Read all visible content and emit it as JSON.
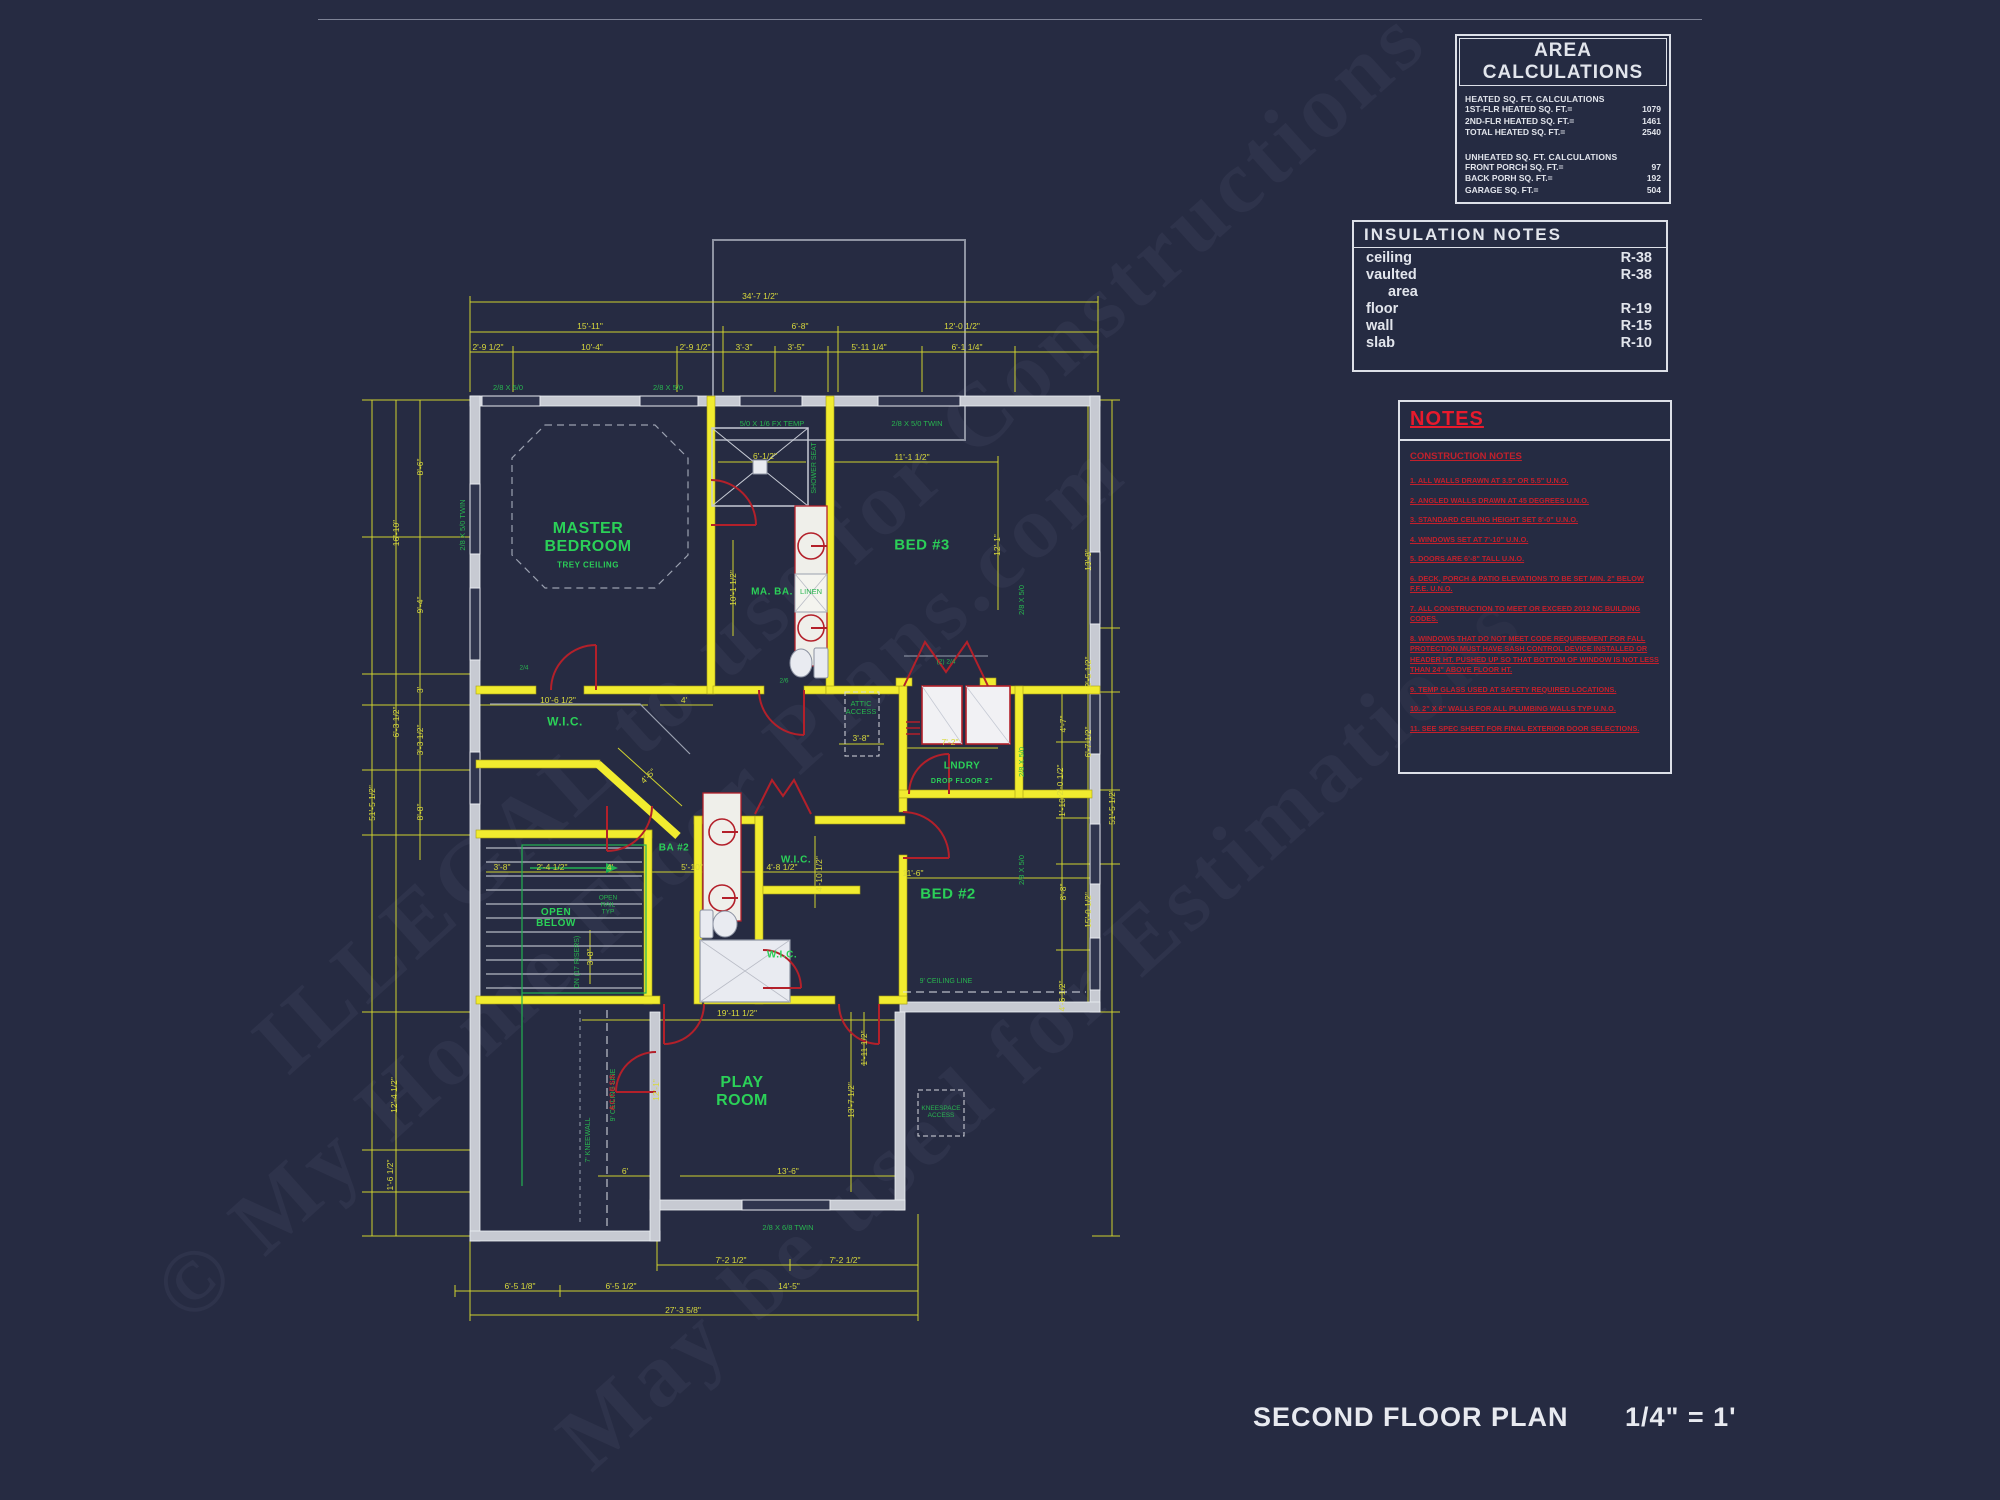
{
  "area_calculations": {
    "title": "AREA CALCULATIONS",
    "heated_header": "HEATED SQ. FT. CALCULATIONS",
    "heated_rows": [
      {
        "label": "1ST-FLR HEATED SQ. FT.=",
        "value": "1079"
      },
      {
        "label": "2ND-FLR HEATED SQ. FT.=",
        "value": "1461"
      },
      {
        "label": "TOTAL HEATED SQ. FT.=",
        "value": "2540"
      }
    ],
    "unheated_header": "UNHEATED SQ. FT. CALCULATIONS",
    "unheated_rows": [
      {
        "label": "FRONT PORCH SQ. FT.=",
        "value": "97"
      },
      {
        "label": "BACK PORH SQ. FT.=",
        "value": "192"
      },
      {
        "label": "GARAGE SQ. FT.=",
        "value": "504"
      }
    ]
  },
  "insulation_notes": {
    "title": "INSULATION  NOTES",
    "rows": [
      {
        "label": "ceiling",
        "value": "R-38"
      },
      {
        "label": "vaulted",
        "value": "R-38"
      },
      {
        "label": "area",
        "value": "",
        "indent": true
      },
      {
        "label": "floor",
        "value": "R-19"
      },
      {
        "label": "wall",
        "value": "R-15"
      },
      {
        "label": "slab",
        "value": "R-10"
      }
    ]
  },
  "notes_panel": {
    "title": "NOTES",
    "subtitle": "CONSTRUCTION NOTES",
    "items": [
      "1.  ALL WALLS DRAWN AT 3.5\" OR 5.5\" U.N.O.",
      "2.  ANGLED WALLS DRAWN AT 45 DEGREES U.N.O.",
      "3.  STANDARD CEILING HEIGHT SET 8'-0\" U.N.O.",
      "4.  WINDOWS SET AT 7'-10\" U.N.O.",
      "5.  DOORS ARE 6'-8\" TALL U.N.O.",
      "6.  DECK, PORCH & PATIO ELEVATIONS TO BE SET MIN. 2\" BELOW F.F.E. U.N.O.",
      "7.  ALL CONSTRUCTION TO MEET OR EXCEED 2012 NC BUILDING CODES.",
      "8.  WINDOWS THAT DO NOT MEET CODE REQUIREMENT FOR FALL PROTECTION MUST HAVE SASH CONTROL DEVICE INSTALLED OR HEADER HT. PUSHED UP SO THAT BOTTOM OF WINDOW IS NOT LESS THAN 24\" ABOVE FLOOR HT.",
      "9.  TEMP GLASS USED AT SAFETY REQUIRED LOCATIONS.",
      "10. 2\" X 6\" WALLS FOR ALL PLUMBING WALLS TYP U.N.O.",
      "11. SEE SPEC SHEET FOR FINAL EXTERIOR DOOR SELECTIONS."
    ]
  },
  "title_block": {
    "title": "SECOND FLOOR PLAN",
    "scale": "1/4\" = 1'"
  },
  "watermarks": [
    {
      "t": "ILLEGAL to use for Constructions",
      "x": 840,
      "y": 540,
      "r": -42,
      "fs": 90
    },
    {
      "t": "© My Home Floor Plans.com",
      "x": 640,
      "y": 880,
      "r": -42,
      "fs": 90
    },
    {
      "t": "May be used for Estimations",
      "x": 1040,
      "y": 1030,
      "r": -42,
      "fs": 90
    }
  ],
  "plan": {
    "rooms": [
      {
        "t": "MASTER\nBEDROOM",
        "x": 588,
        "y": 538,
        "fs": 16,
        "n": "room-label-master-bedroom"
      },
      {
        "t": "TREY CEILING",
        "x": 588,
        "y": 566,
        "fs": 8,
        "n": "label-trey-ceiling"
      },
      {
        "t": "W.I.C.",
        "x": 565,
        "y": 722,
        "fs": 12,
        "n": "room-label-wic-master"
      },
      {
        "t": "BED #3",
        "x": 922,
        "y": 546,
        "fs": 15,
        "n": "room-label-bed3"
      },
      {
        "t": "MA. BA.",
        "x": 772,
        "y": 592,
        "fs": 10,
        "n": "room-label-master-bath"
      },
      {
        "t": "BA #2",
        "x": 674,
        "y": 848,
        "fs": 10,
        "n": "room-label-bath2"
      },
      {
        "t": "W.I.C.",
        "x": 796,
        "y": 860,
        "fs": 10,
        "n": "room-label-wic-bed2"
      },
      {
        "t": "W.I.C.",
        "x": 782,
        "y": 955,
        "fs": 10,
        "n": "room-label-wic-bed3"
      },
      {
        "t": "BED #2",
        "x": 948,
        "y": 895,
        "fs": 15,
        "n": "room-label-bed2"
      },
      {
        "t": "OPEN\nBELOW",
        "x": 556,
        "y": 918,
        "fs": 10,
        "n": "label-open-below"
      },
      {
        "t": "LNDRY",
        "x": 962,
        "y": 766,
        "fs": 10,
        "n": "room-label-laundry"
      },
      {
        "t": "DROP FLOOR 2\"",
        "x": 962,
        "y": 782,
        "fs": 7,
        "n": "label-drop-floor"
      },
      {
        "t": "PLAY\nROOM",
        "x": 742,
        "y": 1092,
        "fs": 16,
        "n": "room-label-play-room"
      }
    ],
    "greens": [
      {
        "t": "2/8 X 5/0",
        "x": 508,
        "y": 388
      },
      {
        "t": "2/8 X 5/0",
        "x": 668,
        "y": 388
      },
      {
        "t": "5/0 X 1/6 FX TEMP",
        "x": 772,
        "y": 424
      },
      {
        "t": "2/8 X 5/0 TWIN",
        "x": 917,
        "y": 424
      },
      {
        "t": "2/8 X 5/0 TWIN",
        "x": 463,
        "y": 525,
        "r": -90
      },
      {
        "t": "2/8 X 5/0",
        "x": 1022,
        "y": 600,
        "r": -90
      },
      {
        "t": "2/8 X 5/0",
        "x": 1022,
        "y": 762,
        "r": -90
      },
      {
        "t": "2/8 X 5/0",
        "x": 1022,
        "y": 870,
        "r": -90
      },
      {
        "t": "2/8 X 6/8 TWIN",
        "x": 788,
        "y": 1228
      },
      {
        "t": "SHOWER SEAT",
        "x": 815,
        "y": 468,
        "r": -90,
        "fs": 7
      },
      {
        "t": "LINEN",
        "x": 811,
        "y": 592
      },
      {
        "t": "ATTIC\nACCESS",
        "x": 861,
        "y": 708
      },
      {
        "t": "KNEESPACE\nACCESS",
        "x": 941,
        "y": 1112,
        "fs": 6.5
      },
      {
        "t": "DN (17 RISERS)",
        "x": 578,
        "y": 962,
        "r": -90,
        "fs": 7
      },
      {
        "t": "OPEN\nRAIL\nTYP",
        "x": 608,
        "y": 905,
        "fs": 6.5
      },
      {
        "t": "7' KNEEWALL",
        "x": 589,
        "y": 1140,
        "r": -90,
        "fs": 7
      },
      {
        "t": "9' CEILING LINE",
        "x": 614,
        "y": 1095,
        "r": -90,
        "fs": 7
      },
      {
        "t": "9' CEILING LINE",
        "x": 946,
        "y": 982,
        "fs": 7
      },
      {
        "t": "(2) 2/4",
        "x": 946,
        "y": 662,
        "fs": 6.5
      },
      {
        "t": "2/4",
        "x": 524,
        "y": 668,
        "fs": 6.5
      },
      {
        "t": "2/6",
        "x": 784,
        "y": 681,
        "fs": 6.5
      }
    ],
    "dims": [
      {
        "t": "34'-7 1/2\"",
        "x": 760,
        "y": 296
      },
      {
        "t": "15'-11\"",
        "x": 590,
        "y": 326
      },
      {
        "t": "6'-8\"",
        "x": 800,
        "y": 326
      },
      {
        "t": "12'-0 1/2\"",
        "x": 962,
        "y": 326
      },
      {
        "t": "2'-9 1/2\"",
        "x": 488,
        "y": 347
      },
      {
        "t": "10'-4\"",
        "x": 592,
        "y": 347
      },
      {
        "t": "2'-9 1/2\"",
        "x": 695,
        "y": 347
      },
      {
        "t": "3'-3\"",
        "x": 744,
        "y": 347
      },
      {
        "t": "3'-5\"",
        "x": 796,
        "y": 347
      },
      {
        "t": "5'-11 1/4\"",
        "x": 869,
        "y": 347
      },
      {
        "t": "6'-1 1/4\"",
        "x": 967,
        "y": 347
      },
      {
        "t": "8'-6\"",
        "x": 420,
        "y": 467,
        "r": -90
      },
      {
        "t": "16'-10\"",
        "x": 396,
        "y": 533,
        "r": -90
      },
      {
        "t": "9'-4\"",
        "x": 420,
        "y": 605,
        "r": -90
      },
      {
        "t": "3'",
        "x": 420,
        "y": 690,
        "r": -90
      },
      {
        "t": "6'-3 1/2\"",
        "x": 396,
        "y": 722,
        "r": -90
      },
      {
        "t": "3'-3 1/2\"",
        "x": 420,
        "y": 740,
        "r": -90
      },
      {
        "t": "8'-8\"",
        "x": 420,
        "y": 812,
        "r": -90
      },
      {
        "t": "51'-5 1/2\"",
        "x": 372,
        "y": 803,
        "r": -90
      },
      {
        "t": "12'-4 1/2\"",
        "x": 394,
        "y": 1095,
        "r": -90
      },
      {
        "t": "1'-6 1/2\"",
        "x": 390,
        "y": 1175,
        "r": -90
      },
      {
        "t": "13'-8\"",
        "x": 1088,
        "y": 560,
        "r": -90
      },
      {
        "t": "2'-5 1/2\"",
        "x": 1088,
        "y": 672,
        "r": -90
      },
      {
        "t": "4'-7\"",
        "x": 1063,
        "y": 724,
        "r": -90
      },
      {
        "t": "6'-7 1/2\"",
        "x": 1088,
        "y": 742,
        "r": -90
      },
      {
        "t": "2'-0 1/2\"",
        "x": 1060,
        "y": 780,
        "r": -90
      },
      {
        "t": "1'-10\"",
        "x": 1062,
        "y": 806,
        "r": -90
      },
      {
        "t": "8'-8\"",
        "x": 1063,
        "y": 892,
        "r": -90
      },
      {
        "t": "15'-0 1/2\"",
        "x": 1088,
        "y": 910,
        "r": -90
      },
      {
        "t": "4'-6 1/2\"",
        "x": 1062,
        "y": 996,
        "r": -90
      },
      {
        "t": "51'-5 1/2\"",
        "x": 1112,
        "y": 807,
        "r": -90
      },
      {
        "t": "7'-2 1/2\"",
        "x": 731,
        "y": 1260
      },
      {
        "t": "7'-2 1/2\"",
        "x": 845,
        "y": 1260
      },
      {
        "t": "6'-5 1/8\"",
        "x": 520,
        "y": 1286
      },
      {
        "t": "6'-5 1/2\"",
        "x": 621,
        "y": 1286
      },
      {
        "t": "14'-5\"",
        "x": 789,
        "y": 1286
      },
      {
        "t": "27'-3 5/8\"",
        "x": 683,
        "y": 1310
      },
      {
        "t": "11'-1 1/2\"",
        "x": 912,
        "y": 457
      },
      {
        "t": "12'-1\"",
        "x": 997,
        "y": 545,
        "r": -90
      },
      {
        "t": "6'-1/2\"",
        "x": 765,
        "y": 456
      },
      {
        "t": "10'-1 1/2\"",
        "x": 733,
        "y": 588,
        "r": -90
      },
      {
        "t": "10'-6 1/2\"",
        "x": 558,
        "y": 700
      },
      {
        "t": "4'",
        "x": 684,
        "y": 700
      },
      {
        "t": "4'-5\"",
        "x": 648,
        "y": 776,
        "r": -45
      },
      {
        "t": "3'-8\"",
        "x": 861,
        "y": 738
      },
      {
        "t": "7'-2\"",
        "x": 950,
        "y": 742
      },
      {
        "t": "3'-8\"",
        "x": 502,
        "y": 867
      },
      {
        "t": "2'-4 1/2\"",
        "x": 552,
        "y": 867
      },
      {
        "t": "4'",
        "x": 610,
        "y": 867
      },
      {
        "t": "5'-10\"",
        "x": 692,
        "y": 867
      },
      {
        "t": "4'-8 1/2\"",
        "x": 782,
        "y": 867
      },
      {
        "t": "4'-10 1/2\"",
        "x": 819,
        "y": 874,
        "r": -90
      },
      {
        "t": "3'-8\"",
        "x": 590,
        "y": 957,
        "r": -90
      },
      {
        "t": "11'-6\"",
        "x": 913,
        "y": 873
      },
      {
        "t": "19'-11 1/2\"",
        "x": 737,
        "y": 1013
      },
      {
        "t": "12'-1\"",
        "x": 656,
        "y": 1090,
        "r": -90
      },
      {
        "t": "13'-7 1/2\"",
        "x": 851,
        "y": 1100,
        "r": -90
      },
      {
        "t": "1'-11 1/2\"",
        "x": 864,
        "y": 1048,
        "r": -90
      },
      {
        "t": "13'-6\"",
        "x": 788,
        "y": 1171
      },
      {
        "t": "6'",
        "x": 625,
        "y": 1171
      }
    ],
    "reds": [
      {
        "t": "ACCESS",
        "x": 612,
        "y": 1092,
        "r": -90
      }
    ]
  }
}
